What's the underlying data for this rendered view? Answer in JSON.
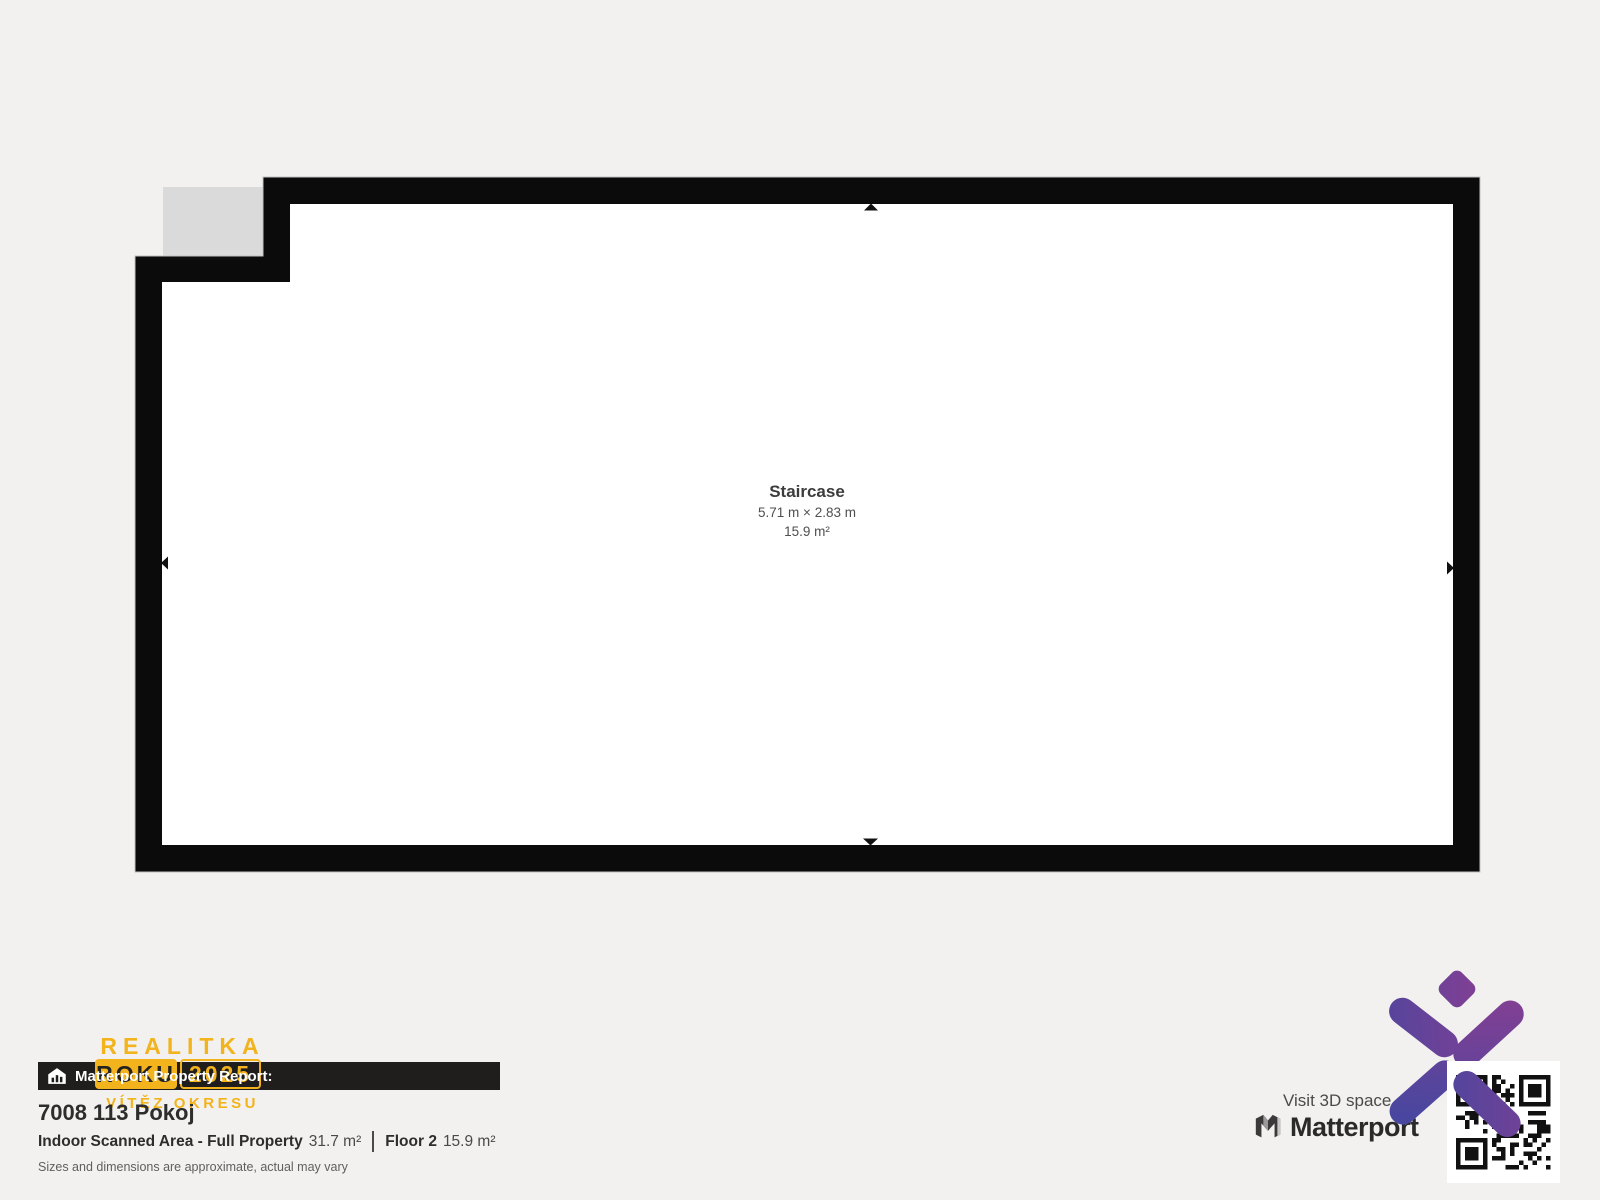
{
  "plan": {
    "room": {
      "name": "Staircase",
      "dimensions": "5.71 m × 2.83 m",
      "area": "15.9 m²"
    }
  },
  "award": {
    "title": "REALITKA",
    "box_word": "ROKU",
    "year": "2025",
    "subtitle": "VÍTĚZ OKRESU",
    "color": "#F2B31C"
  },
  "report": {
    "bar_title": "Matterport Property Report:",
    "property_title": "7008 113 Pokoj",
    "area_label": "Indoor Scanned Area - Full Property",
    "area_value": "31.7 m²",
    "floor_label": "Floor 2",
    "floor_value": "15.9 m²",
    "disclaimer": "Sizes and dimensions are approximate, actual may vary"
  },
  "footer": {
    "visit_text": "Visit 3D space o",
    "brand": "Matterport"
  },
  "icons": {
    "report_bar_icon": "house-chart-icon",
    "brand_icon": "matterport-m-icon",
    "qr": "qr-code",
    "agency_logo": "x-diamond-logo",
    "plan_markers": "direction-arrow-icons"
  },
  "colors": {
    "background": "#F2F1EF",
    "wall": "#0B0B0B",
    "room_fill": "#FFFFFF",
    "excluded_area": "#DADADA",
    "accent_yellow": "#F2B31C",
    "bar_background": "#1F1E1C",
    "logo_gradient_start": "#4547A0",
    "logo_gradient_end": "#8C3E91"
  }
}
